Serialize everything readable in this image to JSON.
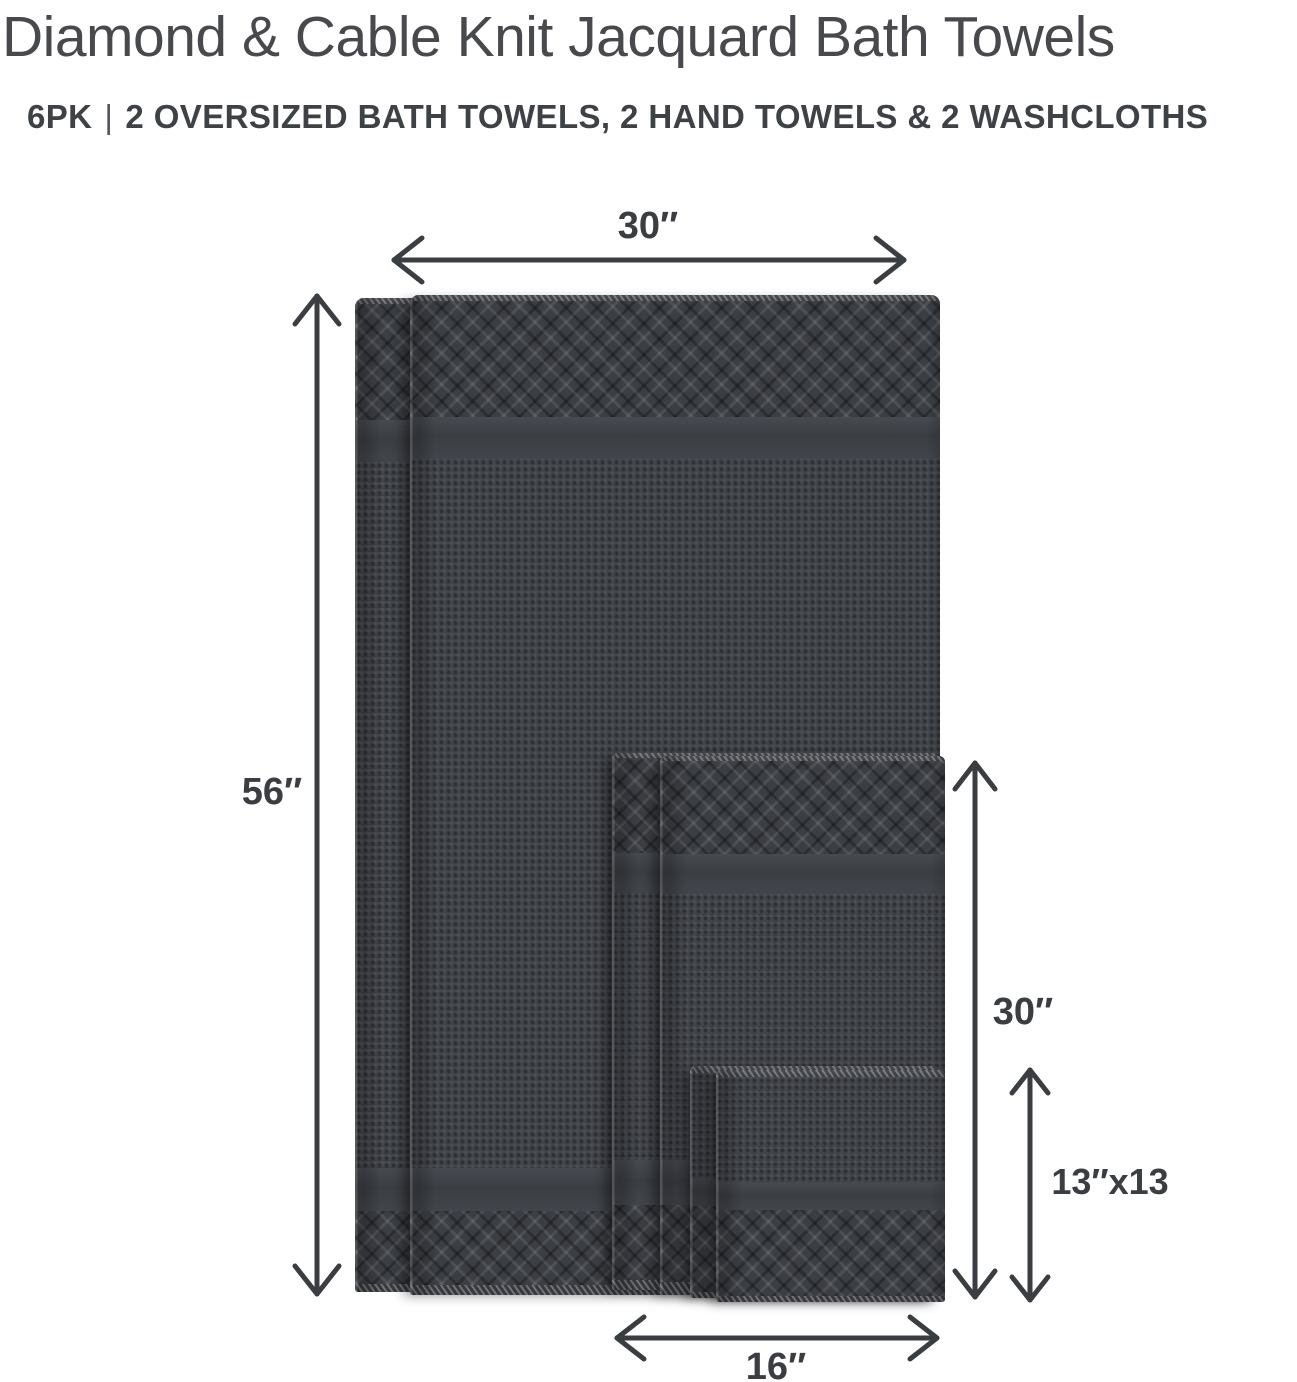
{
  "header": {
    "title": "Diamond & Cable Knit Jacquard Bath Towels",
    "pack": "6PK",
    "separator": "|",
    "contents": "2 OVERSIZED BATH TOWELS, 2 HAND TOWELS & 2 WASHCLOTHS"
  },
  "dimensions": {
    "bath_towel_width": "30″",
    "bath_towel_length": "56″",
    "hand_towel_length": "30″",
    "washcloth_size": "13″x13",
    "hand_towel_width": "16″"
  },
  "items": {
    "bath_towel": "Oversized bath towel (2)",
    "hand_towel": "Hand towel (2)",
    "washcloth": "Washcloth (2)"
  },
  "colors": {
    "background": "#ffffff",
    "heading_text": "#47494d",
    "label_text": "#3a3d41",
    "arrow": "#3a3d41",
    "towel_base": "#42454b",
    "towel_border_dark": "#2f3237",
    "towel_highlight": "#4e5258"
  }
}
